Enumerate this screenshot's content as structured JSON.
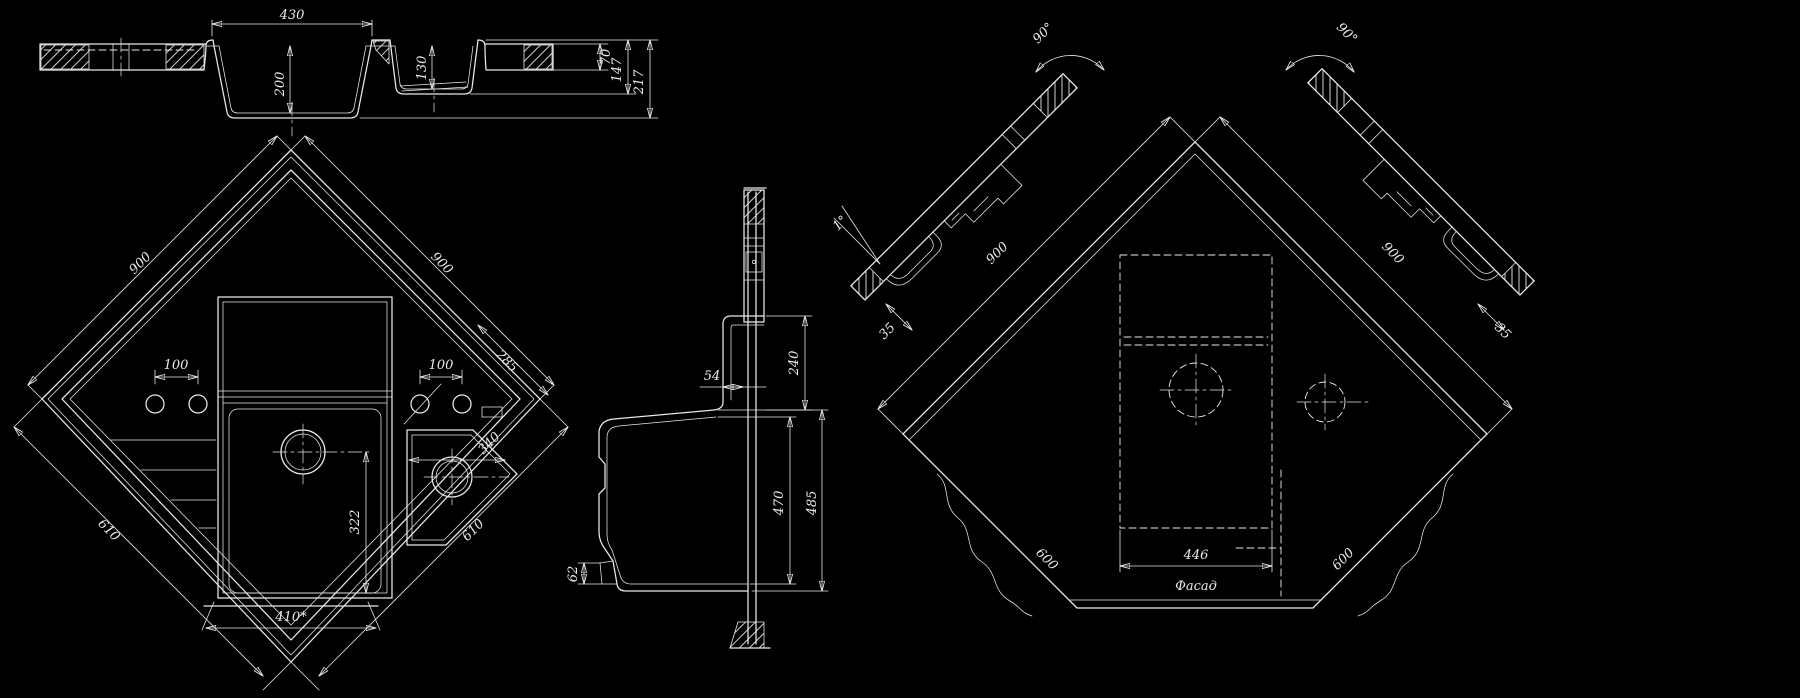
{
  "drawing": {
    "background": "#000000",
    "line_color": "#e9e9e9",
    "views": {
      "section": {
        "width": "430",
        "main_depth": "200",
        "small_depth": "130",
        "rim": "70",
        "mid": "147",
        "total": "217"
      },
      "plan": {
        "edge_ul": "900",
        "edge_ur": "900",
        "hole_l": "100",
        "hole_r": "100",
        "edge_cut": "285",
        "bowl_r": "340",
        "bowl_main": "322",
        "edge_ll": "610",
        "edge_lr": "610",
        "bottom": "410*"
      },
      "profile": {
        "neck": "54",
        "upper": "240",
        "depth_inner": "470",
        "depth_outer": "485",
        "foot": "62"
      },
      "install": {
        "angle_l": "90°",
        "angle_r": "90°",
        "tilt": "1°",
        "offset_l": "35",
        "offset_r": "35",
        "edge_ul": "900",
        "edge_ur": "900",
        "edge_ll": "600",
        "edge_lr": "600",
        "cutout": "446",
        "facade": "Фасад"
      }
    }
  }
}
